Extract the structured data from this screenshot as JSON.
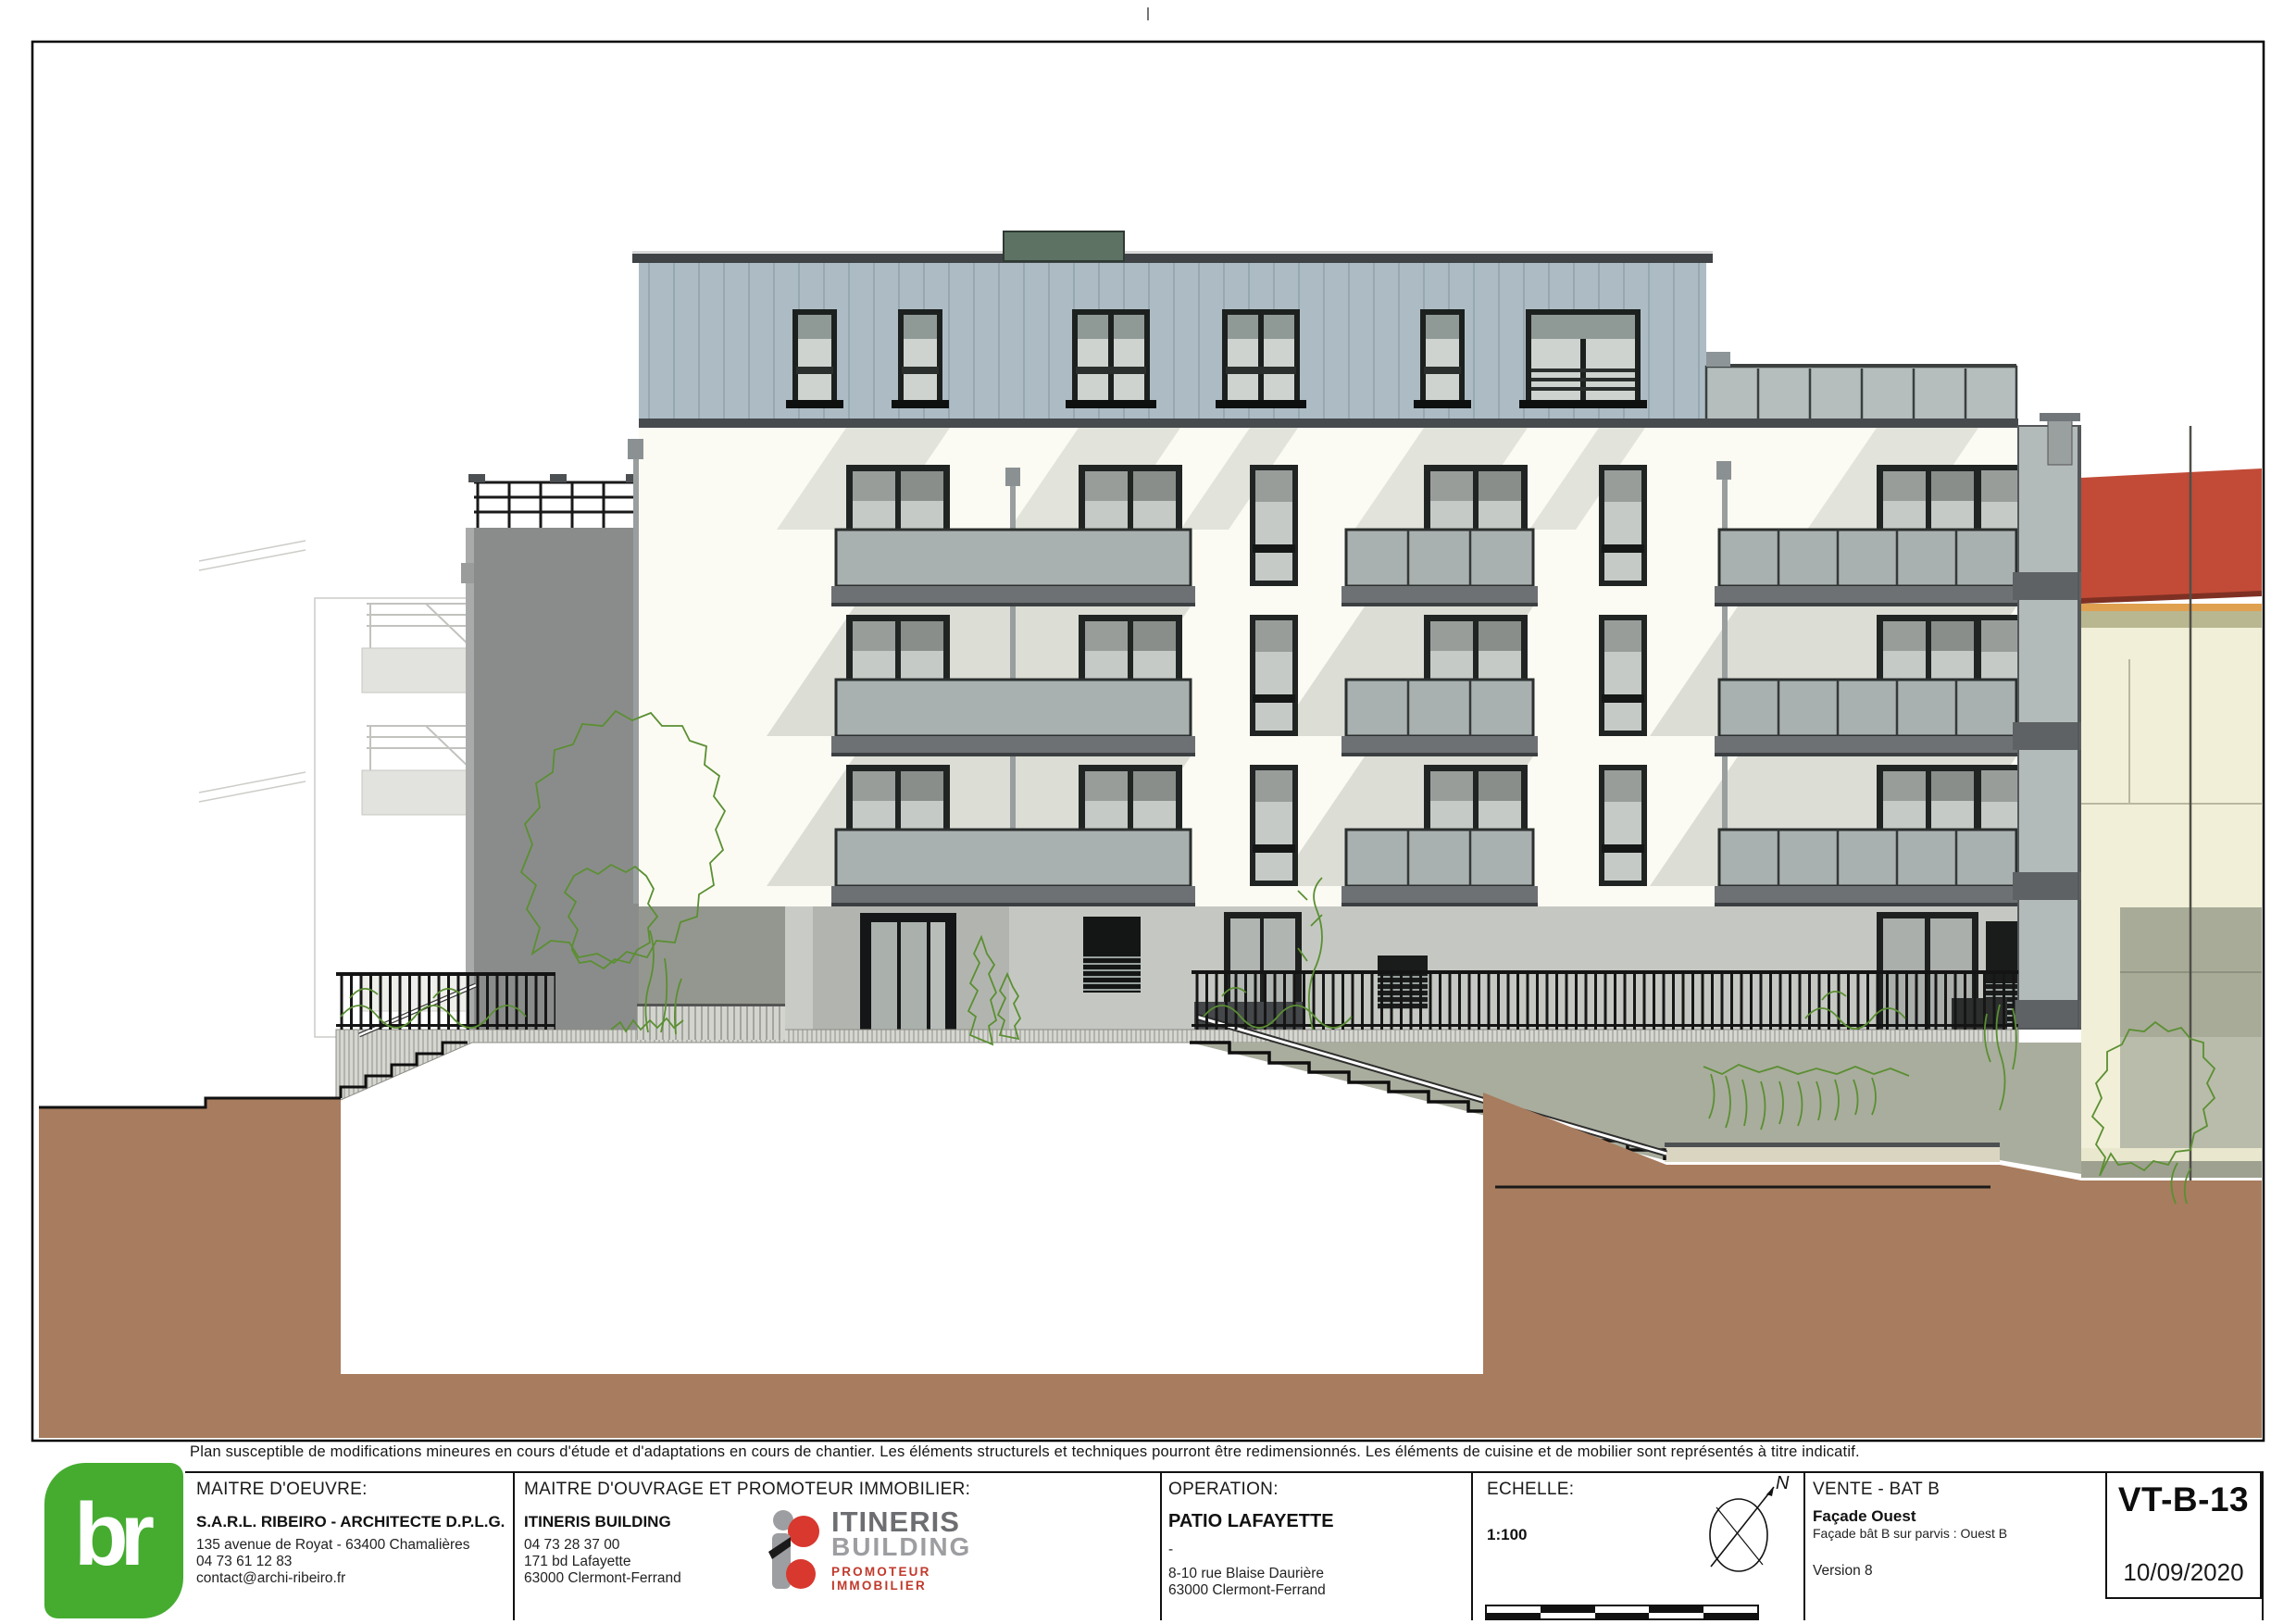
{
  "disclaimer": "Plan susceptible de modifications mineures en cours d'étude et d'adaptations en cours de chantier. Les éléments structurels et techniques pourront être redimensionnés. Les éléments de cuisine et de mobilier sont représentés à titre indicatif.",
  "title_block": {
    "maitre_oeuvre": {
      "label": "MAITRE D'OEUVRE:",
      "name": "S.A.R.L. RIBEIRO - ARCHITECTE D.P.L.G.",
      "address": "135 avenue de Royat - 63400 Chamalières",
      "phone": "04 73 61 12 83",
      "email": "contact@archi-ribeiro.fr"
    },
    "maitre_ouvrage": {
      "label": "MAITRE D'OUVRAGE ET PROMOTEUR IMMOBILIER:",
      "name": "ITINERIS BUILDING",
      "phone": "04 73 28 37 00",
      "address": "171 bd Lafayette",
      "city": "63000 Clermont-Ferrand"
    },
    "itineris_logo": {
      "line1": "ITINERIS",
      "line2": "BUILDING",
      "line3": "PROMOTEUR IMMOBILIER"
    },
    "operation": {
      "label": "OPERATION:",
      "name": "PATIO LAFAYETTE",
      "dash": "-",
      "address": "8-10 rue Blaise Daurière",
      "city": "63000 Clermont-Ferrand"
    },
    "echelle": {
      "label": "ECHELLE:",
      "value": "1:100",
      "north": "N"
    },
    "vente": {
      "label": "VENTE - BAT B",
      "title": "Façade Ouest",
      "subtitle": "Façade bât B sur parvis : Ouest B",
      "version": "Version 8"
    },
    "reference": {
      "code": "VT-B-13",
      "date": "10/09/2020"
    },
    "br_logo": {
      "text": "br"
    }
  },
  "colors": {
    "logo_green": "#45ac30",
    "itineris_red": "#c0392b",
    "zinc_roof": "#adbcc4",
    "roof_box_green": "#5d7263",
    "facade_white": "#fbfbf3",
    "balcony_glass": "#a9b1b0",
    "slab_gray": "#6e7173",
    "ground_gray": "#c5c8c2",
    "earth_brown": "#a87c5e",
    "garden_gray": "#a9ad9d",
    "neighbor_roof_red": "#c14b37",
    "neighbor_wall_cream": "#f1efd7",
    "vegetation_green": "#5b8f33"
  }
}
